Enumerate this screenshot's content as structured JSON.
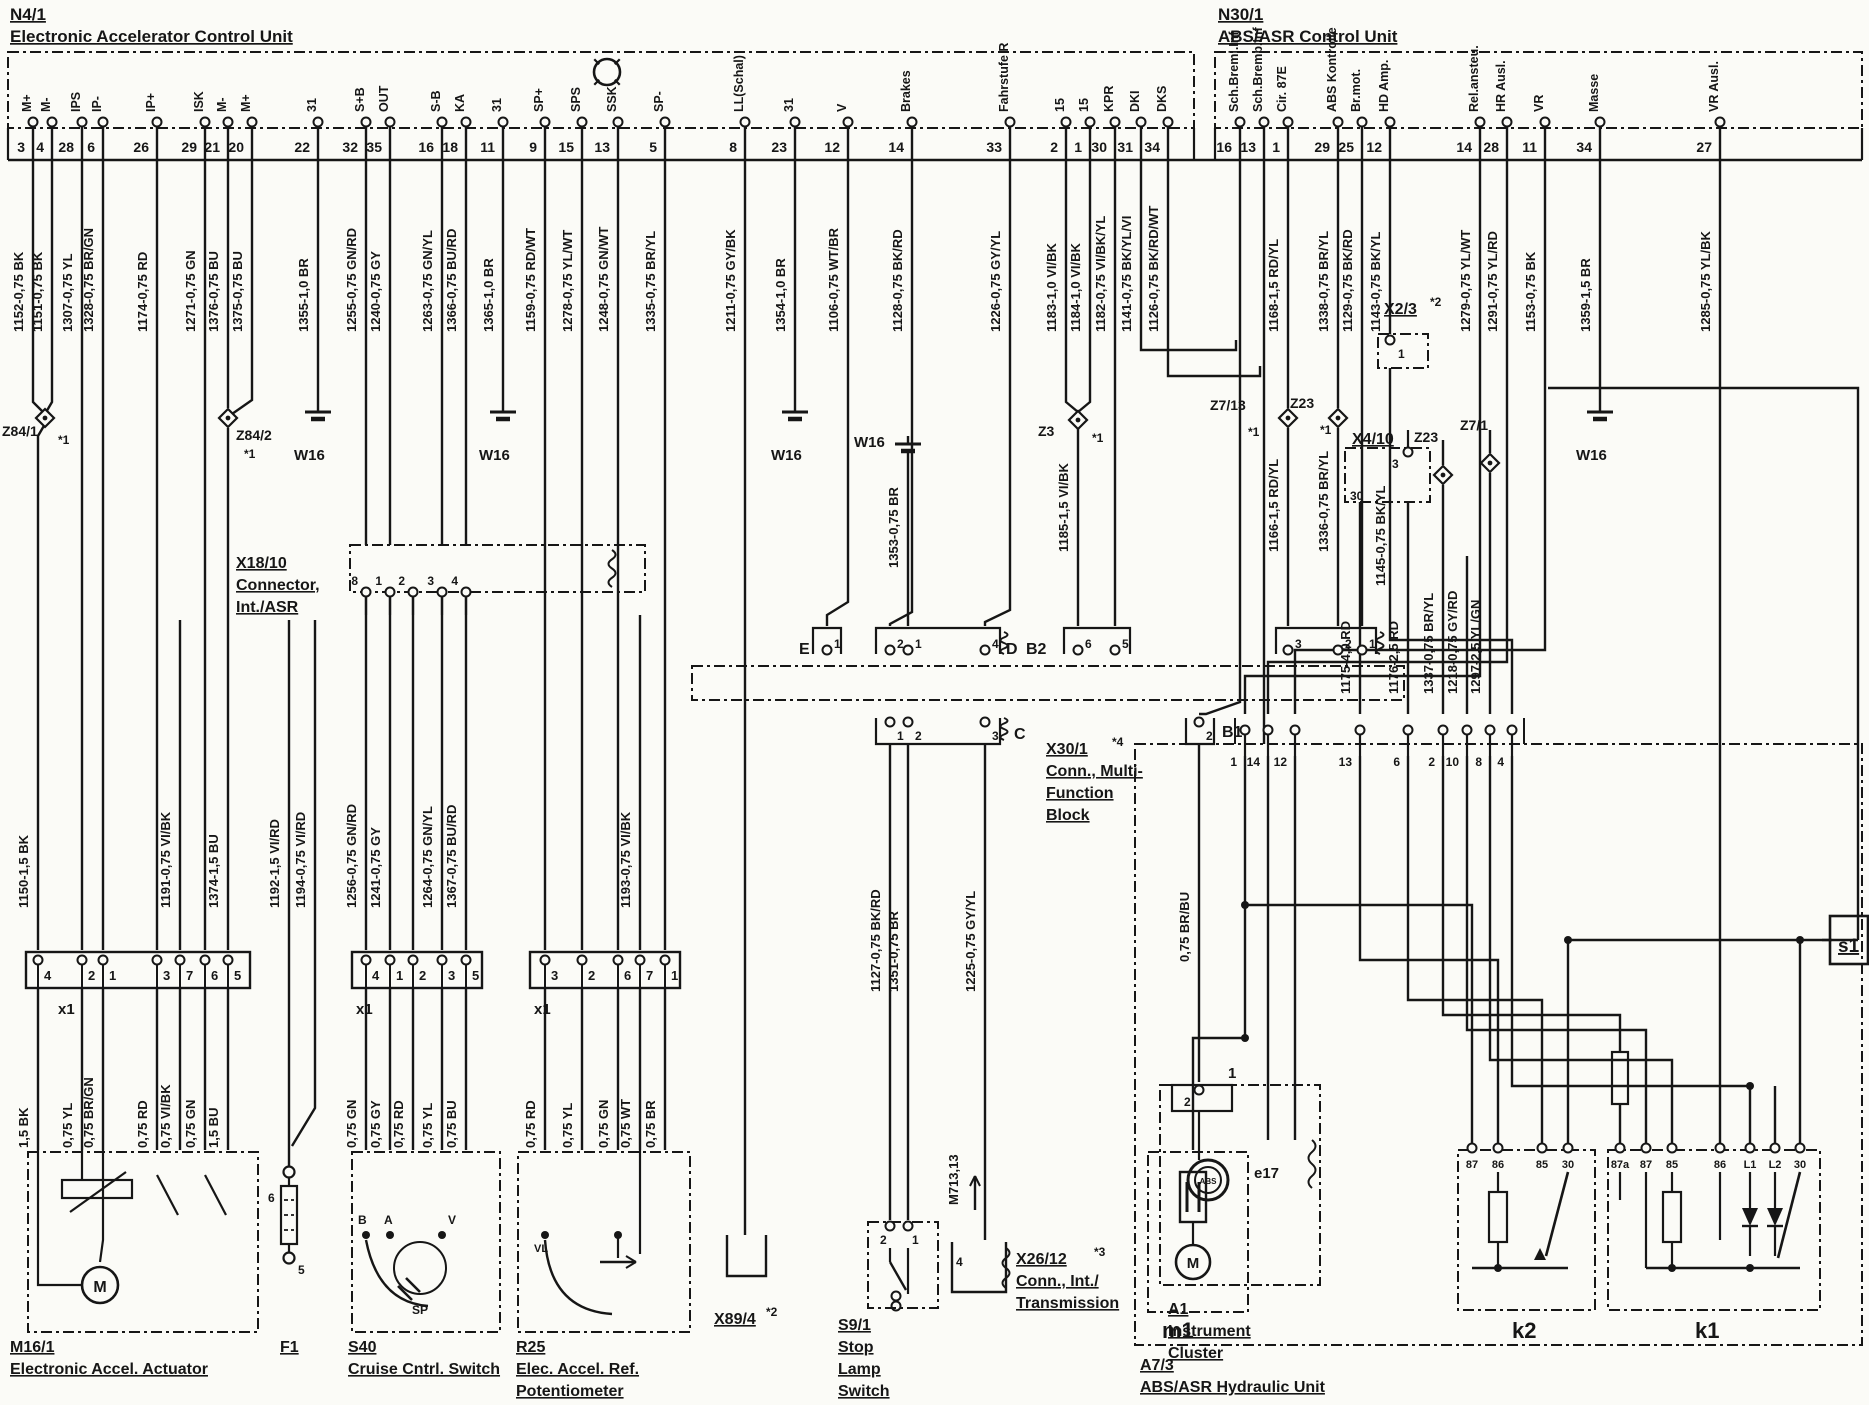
{
  "page": {
    "bg": "#fbfbf7",
    "ink": "#161616",
    "width": 1869,
    "height": 1405
  },
  "units": {
    "n41": {
      "id": "N4/1",
      "name": "Electronic Accelerator Control Unit"
    },
    "n301": {
      "id": "N30/1",
      "name": "ABS/ASR Control Unit"
    }
  },
  "pins": [
    {
      "x": 33,
      "num": "3",
      "top": "M+",
      "wire": "1152-0,75 BK"
    },
    {
      "x": 52,
      "num": "4",
      "top": "M-",
      "wire": "1151-0,75 BK"
    },
    {
      "x": 82,
      "num": "28",
      "top": "IPS",
      "wire": "1307-0,75 YL"
    },
    {
      "x": 103,
      "num": "6",
      "top": "IP-",
      "wire": "1328-0,75 BR/GN"
    },
    {
      "x": 157,
      "num": "26",
      "top": "IP+",
      "wire": "1174-0,75 RD"
    },
    {
      "x": 205,
      "num": "29",
      "top": "ISK",
      "wire": "1271-0,75 GN"
    },
    {
      "x": 228,
      "num": "21",
      "top": "M-",
      "wire": "1376-0,75 BU"
    },
    {
      "x": 252,
      "num": "20",
      "top": "M+",
      "wire": "1375-0,75 BU"
    },
    {
      "x": 318,
      "num": "22",
      "top": "31",
      "wire": "1355-1,0 BR"
    },
    {
      "x": 366,
      "num": "32",
      "top": "S+B",
      "wire": "1255-0,75 GN/RD"
    },
    {
      "x": 390,
      "num": "35",
      "top": "OUT",
      "wire": "1240-0,75 GY"
    },
    {
      "x": 442,
      "num": "16",
      "top": "S-B",
      "wire": "1263-0,75 GN/YL"
    },
    {
      "x": 466,
      "num": "18",
      "top": "KA",
      "wire": "1366-0,75 BU/RD"
    },
    {
      "x": 503,
      "num": "11",
      "top": "31",
      "wire": "1365-1,0 BR"
    },
    {
      "x": 545,
      "num": "9",
      "top": "SP+",
      "wire": "1159-0,75 RD/WT"
    },
    {
      "x": 582,
      "num": "15",
      "top": "SPS",
      "wire": "1278-0,75 YL/WT"
    },
    {
      "x": 618,
      "num": "13",
      "top": "SSK",
      "wire": "1248-0,75 GN/WT"
    },
    {
      "x": 665,
      "num": "5",
      "top": "SP-",
      "wire": "1335-0,75 BR/YL"
    },
    {
      "x": 745,
      "num": "8",
      "top": "LL(Schal)",
      "wire": "1211-0,75 GY/BK"
    },
    {
      "x": 795,
      "num": "23",
      "top": "31",
      "wire": "1354-1,0 BR"
    },
    {
      "x": 848,
      "num": "12",
      "top": "V",
      "wire": "1106-0,75 WT/BR"
    },
    {
      "x": 912,
      "num": "14",
      "top": "Brakes",
      "wire": "1128-0,75 BK/RD"
    },
    {
      "x": 1010,
      "num": "33",
      "top": "Fahrstufe R",
      "wire": "1226-0,75 GY/YL"
    },
    {
      "x": 1066,
      "num": "2",
      "top": "15",
      "wire": "1183-1,0 VI/BK"
    },
    {
      "x": 1090,
      "num": "1",
      "top": "15",
      "wire": "1184-1,0 VI/BK"
    },
    {
      "x": 1115,
      "num": "30",
      "top": "KPR",
      "wire": "1182-0,75 VI/BK/YL"
    },
    {
      "x": 1141,
      "num": "31",
      "top": "DKI",
      "wire": "1141-0,75 BK/YL/VI"
    },
    {
      "x": 1168,
      "num": "34",
      "top": "DKS",
      "wire": "1126-0,75 BK/RD/WT"
    },
    {
      "x": 1240,
      "num": "16",
      "top": "Sch.Breml.Inf",
      "wire": ""
    },
    {
      "x": 1264,
      "num": "13",
      "top": "Sch.Bremb.Inf",
      "wire": ""
    },
    {
      "x": 1288,
      "num": "1",
      "top": "Cir. 87E",
      "wire": "1168-1,5 RD/YL"
    },
    {
      "x": 1338,
      "num": "29",
      "top": "ABS Kontrolle",
      "wire": "1338-0,75 BR/YL"
    },
    {
      "x": 1362,
      "num": "25",
      "top": "Br.mot.",
      "wire": "1129-0,75 BK/RD"
    },
    {
      "x": 1390,
      "num": "12",
      "top": "HD Amp.",
      "wire": "1143-0,75 BK/YL"
    },
    {
      "x": 1480,
      "num": "14",
      "top": "Rel.ansteu.",
      "wire": "1279-0,75 YL/WT"
    },
    {
      "x": 1507,
      "num": "28",
      "top": "HR Ausl.",
      "wire": "1291-0,75 YL/RD"
    },
    {
      "x": 1545,
      "num": "11",
      "top": "VR",
      "wire": "1153-0,75 BK"
    },
    {
      "x": 1600,
      "num": "34",
      "top": "Masse",
      "wire": "1359-1,5 BR"
    },
    {
      "x": 1720,
      "num": "27",
      "top": "VR Ausl.",
      "wire": "1285-0,75 YL/BK"
    }
  ],
  "mid_labels": [
    {
      "x": 38,
      "y": 908,
      "t": "1150-1,5 BK"
    },
    {
      "x": 180,
      "y": 908,
      "t": "1191-0,75 VI/BK"
    },
    {
      "x": 228,
      "y": 908,
      "t": "1374-1,5 BU"
    },
    {
      "x": 289,
      "y": 908,
      "t": "1192-1,5 VI/RD"
    },
    {
      "x": 315,
      "y": 908,
      "t": "1194-0,75 VI/RD"
    },
    {
      "x": 366,
      "y": 908,
      "t": "1256-0,75 GN/RD"
    },
    {
      "x": 390,
      "y": 908,
      "t": "1241-0,75 GY"
    },
    {
      "x": 442,
      "y": 908,
      "t": "1264-0,75 GN/YL"
    },
    {
      "x": 466,
      "y": 908,
      "t": "1367-0,75 BU/RD"
    },
    {
      "x": 640,
      "y": 908,
      "t": "1193-0,75 VI/BK"
    },
    {
      "x": 908,
      "y": 568,
      "t": "1353-0,75 BR"
    },
    {
      "x": 1078,
      "y": 552,
      "t": "1185-1,5 VI/BK"
    },
    {
      "x": 1288,
      "y": 552,
      "t": "1166-1,5 RD/YL"
    },
    {
      "x": 1338,
      "y": 552,
      "t": "1336-0,75 BR/YL"
    },
    {
      "x": 1395,
      "y": 586,
      "t": "1145-0,75 BK/YL"
    },
    {
      "x": 890,
      "y": 992,
      "t": "1127-0,75 BK/RD"
    },
    {
      "x": 908,
      "y": 992,
      "t": "1351-0,75 BR"
    },
    {
      "x": 985,
      "y": 992,
      "t": "1225-0,75 GY/YL"
    },
    {
      "x": 1199,
      "y": 962,
      "t": "0,75 BR/BU"
    },
    {
      "x": 1360,
      "y": 694,
      "t": "1175-4,0 RD"
    },
    {
      "x": 1408,
      "y": 694,
      "t": "1176-2,5 RD"
    },
    {
      "x": 1443,
      "y": 694,
      "t": "1337-0,75 BR/YL"
    },
    {
      "x": 1467,
      "y": 694,
      "t": "1218-0,75 GY/RD"
    },
    {
      "x": 1490,
      "y": 694,
      "t": "1297-2,5 YL/GN"
    },
    {
      "x": 968,
      "y": 1205,
      "t": "M713,13"
    }
  ],
  "bottom_labels": [
    {
      "x": 38,
      "y": 1148,
      "t": "1,5 BK"
    },
    {
      "x": 82,
      "y": 1148,
      "t": "0,75 YL"
    },
    {
      "x": 103,
      "y": 1148,
      "t": "0,75 BR/GN"
    },
    {
      "x": 157,
      "y": 1148,
      "t": "0,75 RD"
    },
    {
      "x": 180,
      "y": 1148,
      "t": "0,75 VI/BK"
    },
    {
      "x": 205,
      "y": 1148,
      "t": "0,75 GN"
    },
    {
      "x": 228,
      "y": 1148,
      "t": "1,5 BU"
    },
    {
      "x": 366,
      "y": 1148,
      "t": "0,75 GN"
    },
    {
      "x": 390,
      "y": 1148,
      "t": "0,75 GY"
    },
    {
      "x": 413,
      "y": 1148,
      "t": "0,75 RD"
    },
    {
      "x": 442,
      "y": 1148,
      "t": "0,75 YL"
    },
    {
      "x": 466,
      "y": 1148,
      "t": "0,75 BU"
    },
    {
      "x": 545,
      "y": 1148,
      "t": "0,75 RD"
    },
    {
      "x": 582,
      "y": 1148,
      "t": "0,75 YL"
    },
    {
      "x": 618,
      "y": 1148,
      "t": "0,75 GN"
    },
    {
      "x": 640,
      "y": 1148,
      "t": "0,75 WT"
    },
    {
      "x": 665,
      "y": 1148,
      "t": "0,75 BR"
    }
  ],
  "captions": [
    {
      "x": 10,
      "y": 1352,
      "lines": [
        "M16/1",
        "Electronic Accel. Actuator"
      ]
    },
    {
      "x": 280,
      "y": 1352,
      "lines": [
        "F1"
      ]
    },
    {
      "x": 348,
      "y": 1352,
      "lines": [
        "S40",
        "Cruise Cntrl. Switch"
      ]
    },
    {
      "x": 516,
      "y": 1352,
      "lines": [
        "R25",
        "Elec. Accel. Ref.",
        "Potentiometer"
      ]
    },
    {
      "x": 714,
      "y": 1324,
      "lines": [
        "X89/4"
      ],
      "note": "*2",
      "nx": 766,
      "ny": 1316
    },
    {
      "x": 838,
      "y": 1330,
      "lines": [
        "S9/1",
        "Stop",
        "Lamp",
        "Switch"
      ]
    },
    {
      "x": 1016,
      "y": 1264,
      "lines": [
        "X26/12",
        "Conn., Int./",
        "Transmission"
      ],
      "note": "*3",
      "nx": 1094,
      "ny": 1256
    },
    {
      "x": 1168,
      "y": 1314,
      "lines": [
        "A1",
        "Instrument",
        "Cluster"
      ]
    },
    {
      "x": 1140,
      "y": 1370,
      "lines": [
        "A7/3",
        "ABS/ASR Hydraulic Unit"
      ]
    },
    {
      "x": 236,
      "y": 568,
      "lines": [
        "X18/10",
        "Connector,",
        "Int./ASR"
      ]
    },
    {
      "x": 1046,
      "y": 754,
      "lines": [
        "X30/1",
        "Conn., Multi-",
        "Function",
        "Block"
      ],
      "note": "*4",
      "nx": 1112,
      "ny": 746
    },
    {
      "x": 1384,
      "y": 314,
      "lines": [
        "X2/3"
      ],
      "note": "*2",
      "nx": 1430,
      "ny": 306
    },
    {
      "x": 1352,
      "y": 444,
      "lines": [
        "X4/10"
      ]
    }
  ],
  "plain_labels": [
    {
      "x": 799,
      "y": 654,
      "t": "E",
      "s": 16
    },
    {
      "x": 1006,
      "y": 654,
      "t": "D",
      "s": 16
    },
    {
      "x": 1026,
      "y": 654,
      "t": "B2",
      "s": 16
    },
    {
      "x": 1014,
      "y": 739,
      "t": "C",
      "s": 16
    },
    {
      "x": 1222,
      "y": 737,
      "t": "B1",
      "s": 16
    },
    {
      "x": 58,
      "y": 1014,
      "t": "x1",
      "s": 15
    },
    {
      "x": 356,
      "y": 1014,
      "t": "x1",
      "s": 15
    },
    {
      "x": 534,
      "y": 1014,
      "t": "x1",
      "s": 15
    },
    {
      "x": 294,
      "y": 460,
      "t": "W16",
      "s": 15
    },
    {
      "x": 479,
      "y": 460,
      "t": "W16",
      "s": 15
    },
    {
      "x": 771,
      "y": 460,
      "t": "W16",
      "s": 15
    },
    {
      "x": 854,
      "y": 447,
      "t": "W16",
      "s": 15
    },
    {
      "x": 1576,
      "y": 460,
      "t": "W16",
      "s": 15
    },
    {
      "x": 2,
      "y": 436,
      "t": "Z84/1",
      "s": 14
    },
    {
      "x": 58,
      "y": 444,
      "t": "*1",
      "s": 12
    },
    {
      "x": 236,
      "y": 440,
      "t": "Z84/2",
      "s": 14
    },
    {
      "x": 244,
      "y": 458,
      "t": "*1",
      "s": 12
    },
    {
      "x": 1038,
      "y": 436,
      "t": "Z3",
      "s": 14
    },
    {
      "x": 1092,
      "y": 442,
      "t": "*1",
      "s": 12
    },
    {
      "x": 1210,
      "y": 410,
      "t": "Z7/13",
      "s": 14
    },
    {
      "x": 1248,
      "y": 436,
      "t": "*1",
      "s": 12
    },
    {
      "x": 1290,
      "y": 408,
      "t": "Z23",
      "s": 14
    },
    {
      "x": 1320,
      "y": 434,
      "t": "*1",
      "s": 12
    },
    {
      "x": 1414,
      "y": 442,
      "t": "Z23",
      "s": 14
    },
    {
      "x": 1460,
      "y": 430,
      "t": "Z7/1",
      "s": 14
    },
    {
      "x": 1350,
      "y": 500,
      "t": "30",
      "s": 12
    },
    {
      "x": 1392,
      "y": 468,
      "t": "3",
      "s": 12
    },
    {
      "x": 1398,
      "y": 358,
      "t": "1",
      "s": 12
    },
    {
      "x": 1254,
      "y": 1178,
      "t": "e17",
      "s": 15
    },
    {
      "x": 1228,
      "y": 1078,
      "t": "1",
      "s": 15
    },
    {
      "x": 1184,
      "y": 1106,
      "t": "2",
      "s": 12
    },
    {
      "x": 880,
      "y": 1244,
      "t": "2",
      "s": 12
    },
    {
      "x": 912,
      "y": 1244,
      "t": "1",
      "s": 12
    },
    {
      "x": 956,
      "y": 1266,
      "t": "4",
      "s": 12
    },
    {
      "x": 268,
      "y": 1202,
      "t": "6",
      "s": 12
    },
    {
      "x": 298,
      "y": 1274,
      "t": "5",
      "s": 12
    },
    {
      "x": 1162,
      "y": 1338,
      "t": "m1",
      "s": 22
    },
    {
      "x": 1512,
      "y": 1338,
      "t": "k2",
      "s": 22
    },
    {
      "x": 1695,
      "y": 1338,
      "t": "k1",
      "s": 22
    },
    {
      "x": 1838,
      "y": 952,
      "t": "s1",
      "s": 19
    }
  ],
  "relay_pins": {
    "k2": [
      [
        "87",
        1472
      ],
      [
        "86",
        1498
      ],
      [
        "85",
        1542
      ],
      [
        "30",
        1568
      ]
    ],
    "k1": [
      [
        "87a",
        1620
      ],
      [
        "87",
        1646
      ],
      [
        "85",
        1672
      ],
      [
        "86",
        1720
      ],
      [
        "L1",
        1750
      ],
      [
        "L2",
        1775
      ],
      [
        "30",
        1800
      ]
    ]
  },
  "row_pins": [
    [
      "1",
      1245
    ],
    [
      "14",
      1268
    ],
    [
      "12",
      1295
    ],
    [
      "13",
      1360
    ],
    [
      "6",
      1408
    ],
    [
      "2",
      1443
    ],
    [
      "10",
      1467
    ],
    [
      "8",
      1490
    ],
    [
      "4",
      1512
    ]
  ],
  "conn_pins": {
    "row1": [
      [
        "1",
        827
      ],
      [
        "2",
        890
      ],
      [
        "1",
        908
      ],
      [
        "4",
        985
      ],
      [
        "6",
        1078
      ],
      [
        "5",
        1115
      ],
      [
        "3",
        1288
      ],
      [
        "2",
        1338
      ],
      [
        "1",
        1362
      ]
    ],
    "row2": [
      [
        "1",
        890
      ],
      [
        "2",
        908
      ],
      [
        "3",
        985
      ]
    ],
    "b1": [
      [
        "2",
        1199
      ]
    ],
    "x18": [
      [
        "8",
        366
      ],
      [
        "1",
        390
      ],
      [
        "2",
        413
      ],
      [
        "3",
        442
      ],
      [
        "4",
        466
      ]
    ],
    "x1a": [
      [
        "4",
        38
      ],
      [
        "2",
        82
      ],
      [
        "1",
        103
      ],
      [
        "3",
        157
      ],
      [
        "7",
        180
      ],
      [
        "6",
        205
      ],
      [
        "5",
        228
      ]
    ],
    "x1b": [
      [
        "4",
        366
      ],
      [
        "1",
        390
      ],
      [
        "2",
        413
      ],
      [
        "3",
        442
      ],
      [
        "5",
        466
      ]
    ],
    "x1c": [
      [
        "3",
        545
      ],
      [
        "2",
        582
      ],
      [
        "6",
        618
      ],
      [
        "7",
        640
      ],
      [
        "1",
        665
      ]
    ]
  },
  "s40_letters": [
    [
      "B",
      358
    ],
    [
      "A",
      384
    ],
    [
      "V",
      448
    ]
  ],
  "s40_sp": "SP",
  "r25_tag": "VL",
  "motor_letter": "M",
  "abs_lamp": "ABS"
}
